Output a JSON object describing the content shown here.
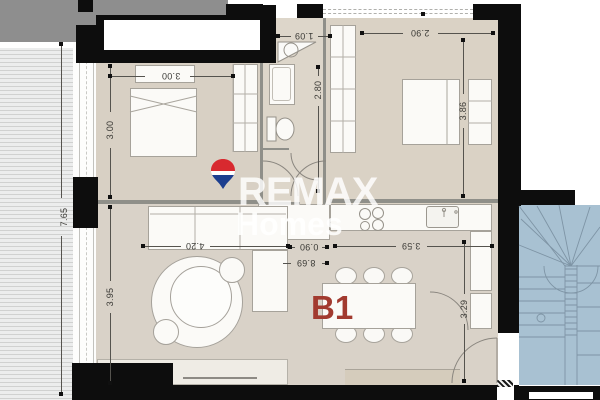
{
  "branding": {
    "name": "REMAX",
    "sub": "Homes"
  },
  "unit": {
    "label": "B1"
  },
  "dims": {
    "bedroom1_w": "3.00",
    "bedroom1_d": "3.00",
    "bath_w": "1.09",
    "bedroom2_w": "2.90",
    "hall_d": "2.80",
    "bedroom2_d": "3.86",
    "facade_d": "7.65",
    "living_w": "4.20",
    "pass_w": "0.90",
    "total_w": "8.69",
    "kitchen_w": "3.59",
    "living_d": "3.95",
    "entry_d": "3.29"
  },
  "colors": {
    "wall": "#0d0d0d",
    "floor_living": "#d9d2c8",
    "floor_bedroom": "#d8d0c4",
    "floor_hall_bath": "#ddd6ca",
    "balcony": "#eceded",
    "adjacent_block": "#8e8e8e",
    "stairwell_blue": "#a8c1d2",
    "unit_label_red": "#a23a2f",
    "balloon_red": "#d8292f",
    "balloon_blue": "#1c3e8f",
    "watermark_white": "#ffffff",
    "dimension_text": "#3b3a36"
  }
}
